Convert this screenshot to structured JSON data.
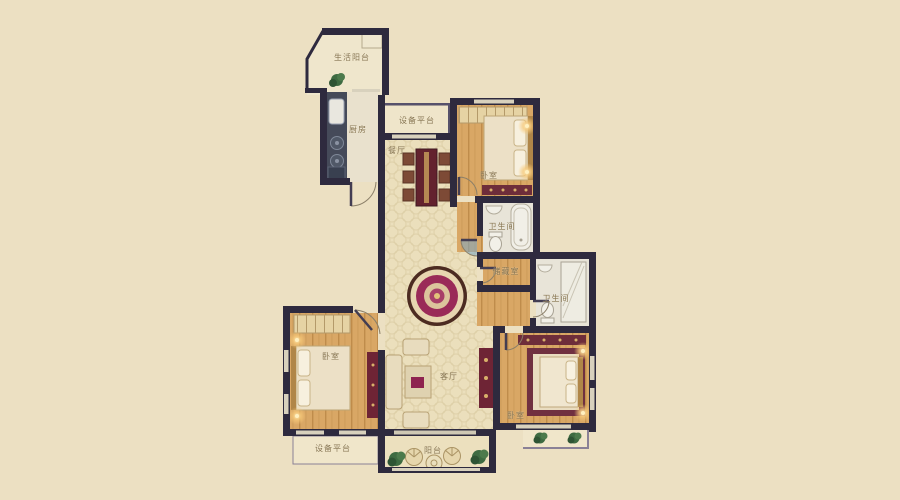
{
  "colors": {
    "background": "#ece0c2",
    "wall": "#2e2a3e",
    "wood_floor": "#d9a765",
    "hall_floor": "#ebdfbc",
    "bath_floor": "#e8e4d8",
    "accent_red": "#8e2350",
    "label_text": "#85734f"
  },
  "rooms": {
    "life_balcony": {
      "label": "生活阳台"
    },
    "kitchen": {
      "label": "厨房"
    },
    "equipment_platform_top": {
      "label": "设备平台"
    },
    "dining_room": {
      "label": "餐厅"
    },
    "bedroom_top": {
      "label": "卧室"
    },
    "bathroom_top": {
      "label": "卫生间"
    },
    "storage_room": {
      "label": "储藏室"
    },
    "bathroom_right": {
      "label": "卫生间"
    },
    "bedroom_left": {
      "label": "卧室"
    },
    "living_room": {
      "label": "客厅"
    },
    "bedroom_right": {
      "label": "卧室"
    },
    "equipment_platform_bottom": {
      "label": "设备平台"
    },
    "balcony": {
      "label": "阳台"
    }
  }
}
